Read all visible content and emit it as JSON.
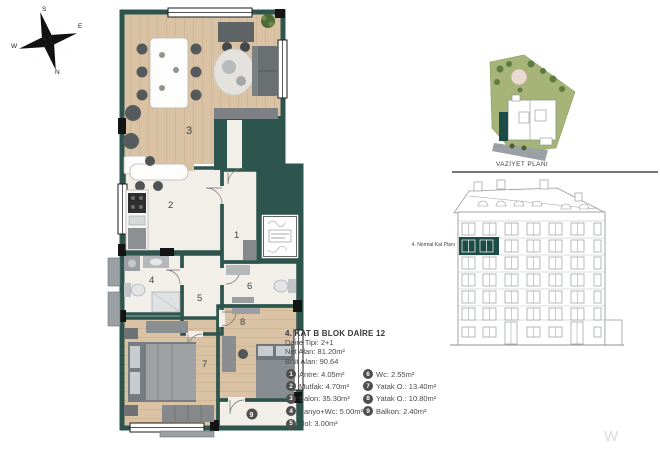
{
  "info": {
    "title": "4. KAT B BLOK DAİRE 12",
    "type_line": "Daire Tipi: 2+1",
    "net_line": "Net Alan: 81.20m²",
    "brut_line": "Brüt Alan: 90.64"
  },
  "legend": {
    "col1": [
      {
        "num": "1",
        "text": "Antre: 4.05m²"
      },
      {
        "num": "2",
        "text": "Mutfak: 4.70m²"
      },
      {
        "num": "3",
        "text": "Salon: 35.30m²"
      },
      {
        "num": "4",
        "text": "Banyo+Wc: 5.00m²"
      },
      {
        "num": "5",
        "text": "Hol: 3.00m²"
      }
    ],
    "col2": [
      {
        "num": "6",
        "text": "Wc: 2.55m²"
      },
      {
        "num": "7",
        "text": "Yatak O.: 13.40m²"
      },
      {
        "num": "8",
        "text": "Yatak O.: 10.80m²"
      },
      {
        "num": "9",
        "text": "Balkon: 2.40m²"
      }
    ]
  },
  "room_numbers": {
    "antre": "1",
    "mutfak": "2",
    "salon": "3",
    "banyo": "4",
    "hol": "5",
    "wc": "6",
    "yatak7": "7",
    "yatak8": "8",
    "balkon": "9"
  },
  "site_plan": {
    "label": "VAZİYET PLANI"
  },
  "elevation": {
    "label": "4. Normal Kat Planı"
  },
  "compass": {
    "n": "N",
    "s": "S",
    "e": "E",
    "w": "W"
  },
  "watermark": "W",
  "colors": {
    "wall": "#2d544d",
    "wood_floor": "#d9c3a4",
    "tile_floor": "#f1efe8",
    "highlight": "#1d4b45",
    "site_green": "#a7b477",
    "tree_green": "#5e7b40",
    "road_gray": "#9aa0a3",
    "badge": "#4d4d4d",
    "text": "#4a4a4a"
  }
}
